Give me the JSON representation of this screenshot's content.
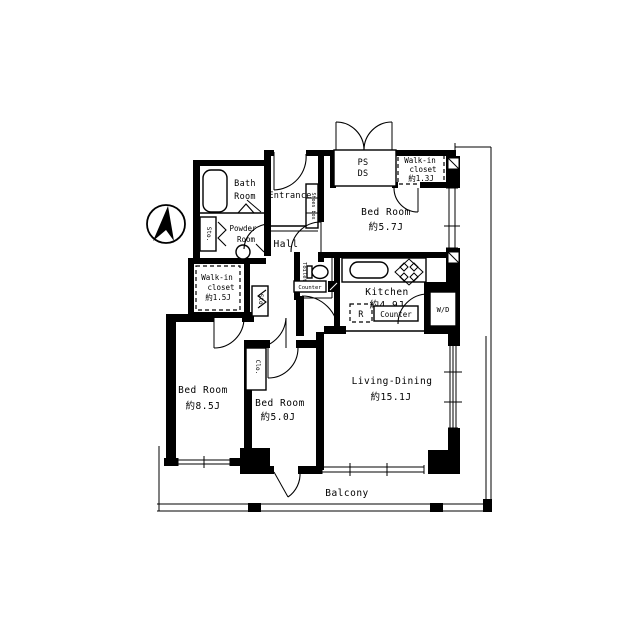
{
  "document": {
    "type": "apartment-floor-plan",
    "orientation_mark": "north-arrow"
  },
  "colors": {
    "ink": "#000000",
    "background": "#ffffff"
  },
  "labels": {
    "bath_1": "Bath",
    "bath_2": "Room",
    "entrance": "Entrance",
    "shoes_box": "Shoes box",
    "ps": "PS",
    "ds": "DS",
    "wic13_1": "Walk-in",
    "wic13_2": "closet",
    "wic13_3": "約1.3J",
    "bed57_1": "Bed Room",
    "bed57_2": "約5.7J",
    "powder_1": "Powder",
    "powder_2": "Room",
    "hall": "Hall",
    "sto_powder": "Sto.",
    "sto_hall": "Sto.",
    "toilet": "Toilet",
    "counter_toilet": "Counter",
    "kitchen_1": "Kitchen",
    "kitchen_2": "約4.9J",
    "fridge": "R",
    "counter_kitchen": "Counter",
    "wd": "W/D",
    "wic15_1": "Walk-in",
    "wic15_2": "closet",
    "wic15_3": "約1.5J",
    "clo": "Clo.",
    "bed85_1": "Bed Room",
    "bed85_2": "約8.5J",
    "bed50_1": "Bed Room",
    "bed50_2": "約5.0J",
    "living_1": "Living-Dining",
    "living_2": "約15.1J",
    "balcony": "Balcony"
  },
  "rooms": [
    {
      "name": "Bed Room",
      "size": "約5.7J"
    },
    {
      "name": "Bed Room",
      "size": "約8.5J"
    },
    {
      "name": "Bed Room",
      "size": "約5.0J"
    },
    {
      "name": "Living-Dining",
      "size": "約15.1J"
    },
    {
      "name": "Kitchen",
      "size": "約4.9J"
    },
    {
      "name": "Walk-in closet",
      "size": "約1.3J"
    },
    {
      "name": "Walk-in closet",
      "size": "約1.5J"
    },
    {
      "name": "Bath Room",
      "size": ""
    },
    {
      "name": "Powder Room",
      "size": ""
    },
    {
      "name": "Entrance",
      "size": ""
    },
    {
      "name": "Hall",
      "size": ""
    },
    {
      "name": "Toilet",
      "size": ""
    },
    {
      "name": "Balcony",
      "size": ""
    }
  ],
  "fixtures": [
    "bathtub",
    "wash-basin",
    "toilet-bowl",
    "kitchen-sink",
    "gas-stove",
    "refrigerator",
    "washer-dryer",
    "shoes-box",
    "counter"
  ]
}
